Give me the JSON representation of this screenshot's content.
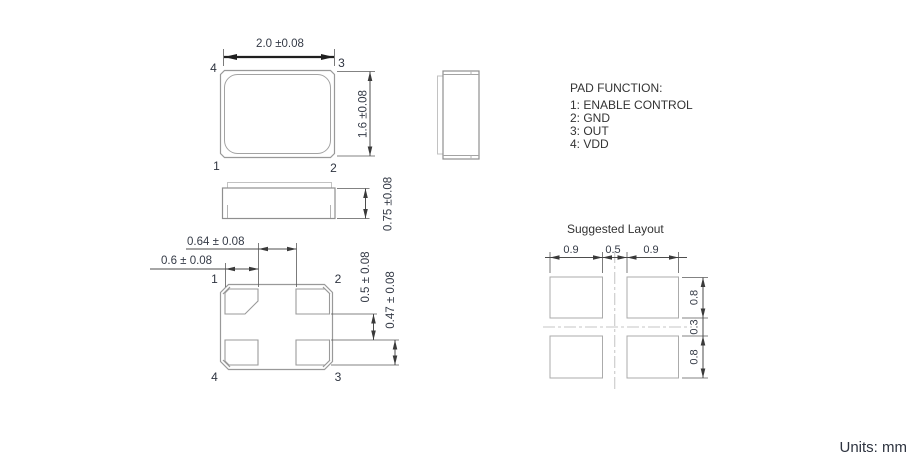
{
  "colors": {
    "outline_gray": "#999999",
    "dimension_line": "#4d4d4d",
    "text": "#353b47",
    "centerline": "#c4c4c4",
    "layout_pad": "#ababab"
  },
  "top_view": {
    "dim_width": "2.0 ±0.08",
    "dim_height": "1.6 ±0.08",
    "pad_top_left": "4",
    "pad_top_right": "3",
    "pad_bottom_left": "1",
    "pad_bottom_right": "2"
  },
  "front_view": {
    "dim_height": "0.75 ±0.08"
  },
  "bottom_view": {
    "dim_pad_gap": "0.64 ± 0.08",
    "dim_pad_width": "0.6 ± 0.08",
    "dim_vertical_gap": "0.5 ± 0.08",
    "dim_pad_height": "0.47 ± 0.08",
    "pad_top_left": "1",
    "pad_top_right": "2",
    "pad_bottom_left": "4",
    "pad_bottom_right": "3"
  },
  "pad_function": {
    "title": "PAD FUNCTION:",
    "items": [
      "1: ENABLE CONTROL",
      "2: GND",
      "3: OUT",
      "4: VDD"
    ]
  },
  "suggested_layout": {
    "title": "Suggested Layout",
    "dim_left_pad_width": "0.9",
    "dim_center_gap": "0.5",
    "dim_right_pad_width": "0.9",
    "dim_top_pad_height": "0.8",
    "dim_middle_gap": "0.3",
    "dim_bottom_pad_height": "0.8"
  },
  "footer": {
    "units_label": "Units: mm"
  }
}
